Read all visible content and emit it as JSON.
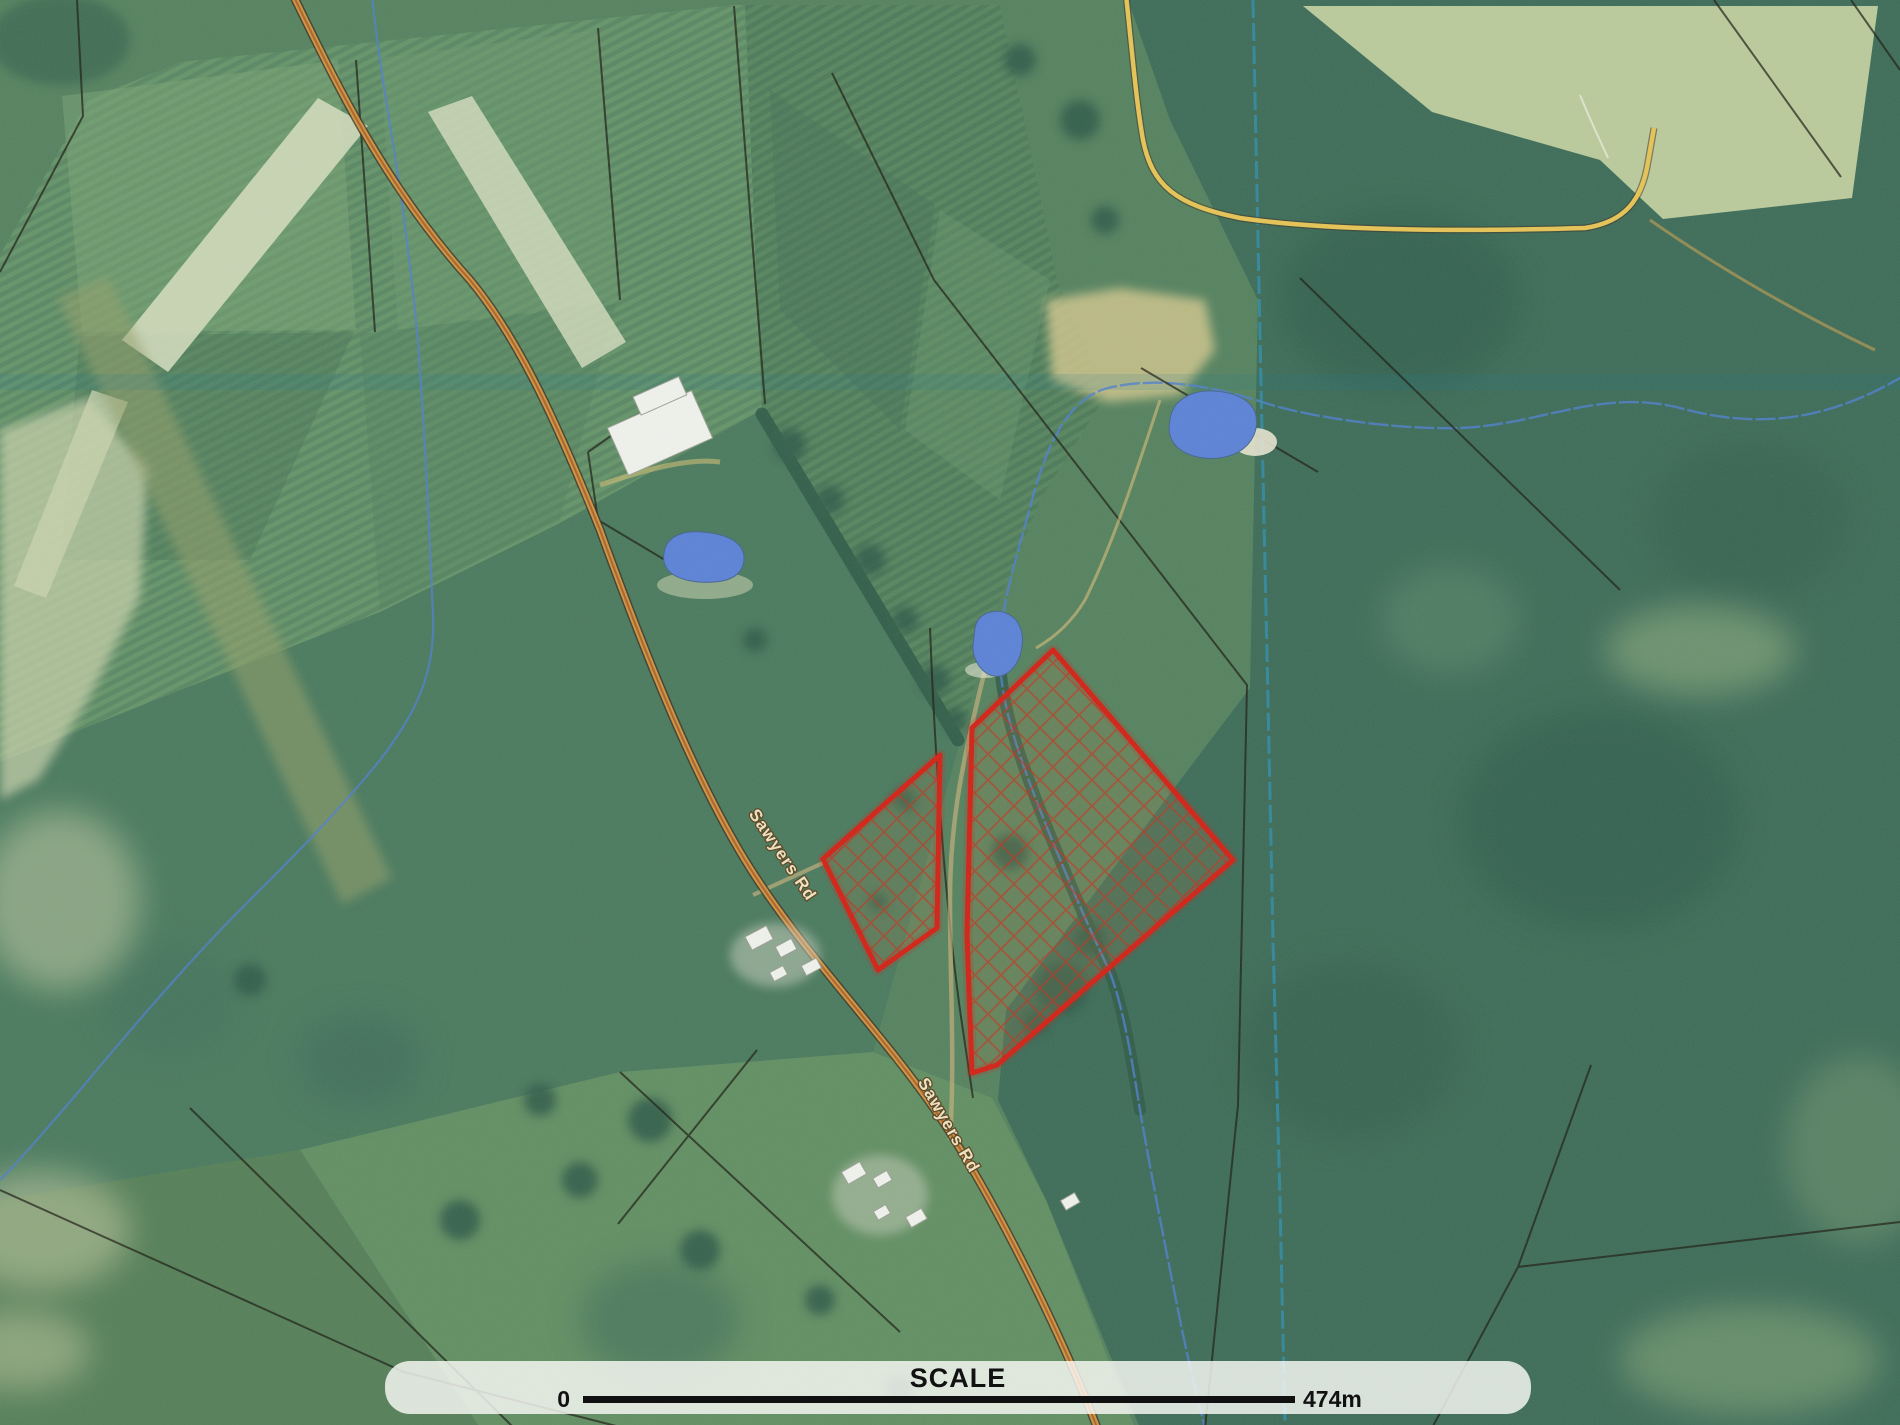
{
  "map_overlay": {
    "scale_bar": {
      "title": "SCALE",
      "start_label": "0",
      "end_label": "474m"
    },
    "road_label": "Sawyers Rd"
  },
  "features": {
    "highlighted_parcels": 2,
    "parcel_hatch": "red diagonal cross-hatch",
    "ponds": 3,
    "main_road": "orange sealed road running NNW-SSE",
    "side_road": "yellow unsealed road, top right",
    "watercourses": "blue creek lines",
    "imagery": "aerial photograph with cadastral boundaries"
  },
  "colors": {
    "parcel-red": "#d42015",
    "road-orange": "#d4923f",
    "road-centerline": "#a55f28",
    "road-casing": "#3a3326",
    "side-road-yellow": "#e8c455",
    "water-blue": "#5b82d8",
    "stream-blue": "#4f7fd0",
    "cadastral-teal": "#2f8fae",
    "cadastral-black": "#1c1c12",
    "road-label-text": "#f2e3c2",
    "scalebar-bg": "rgba(250,250,247,0.82)",
    "scalebar-text": "#111111"
  }
}
